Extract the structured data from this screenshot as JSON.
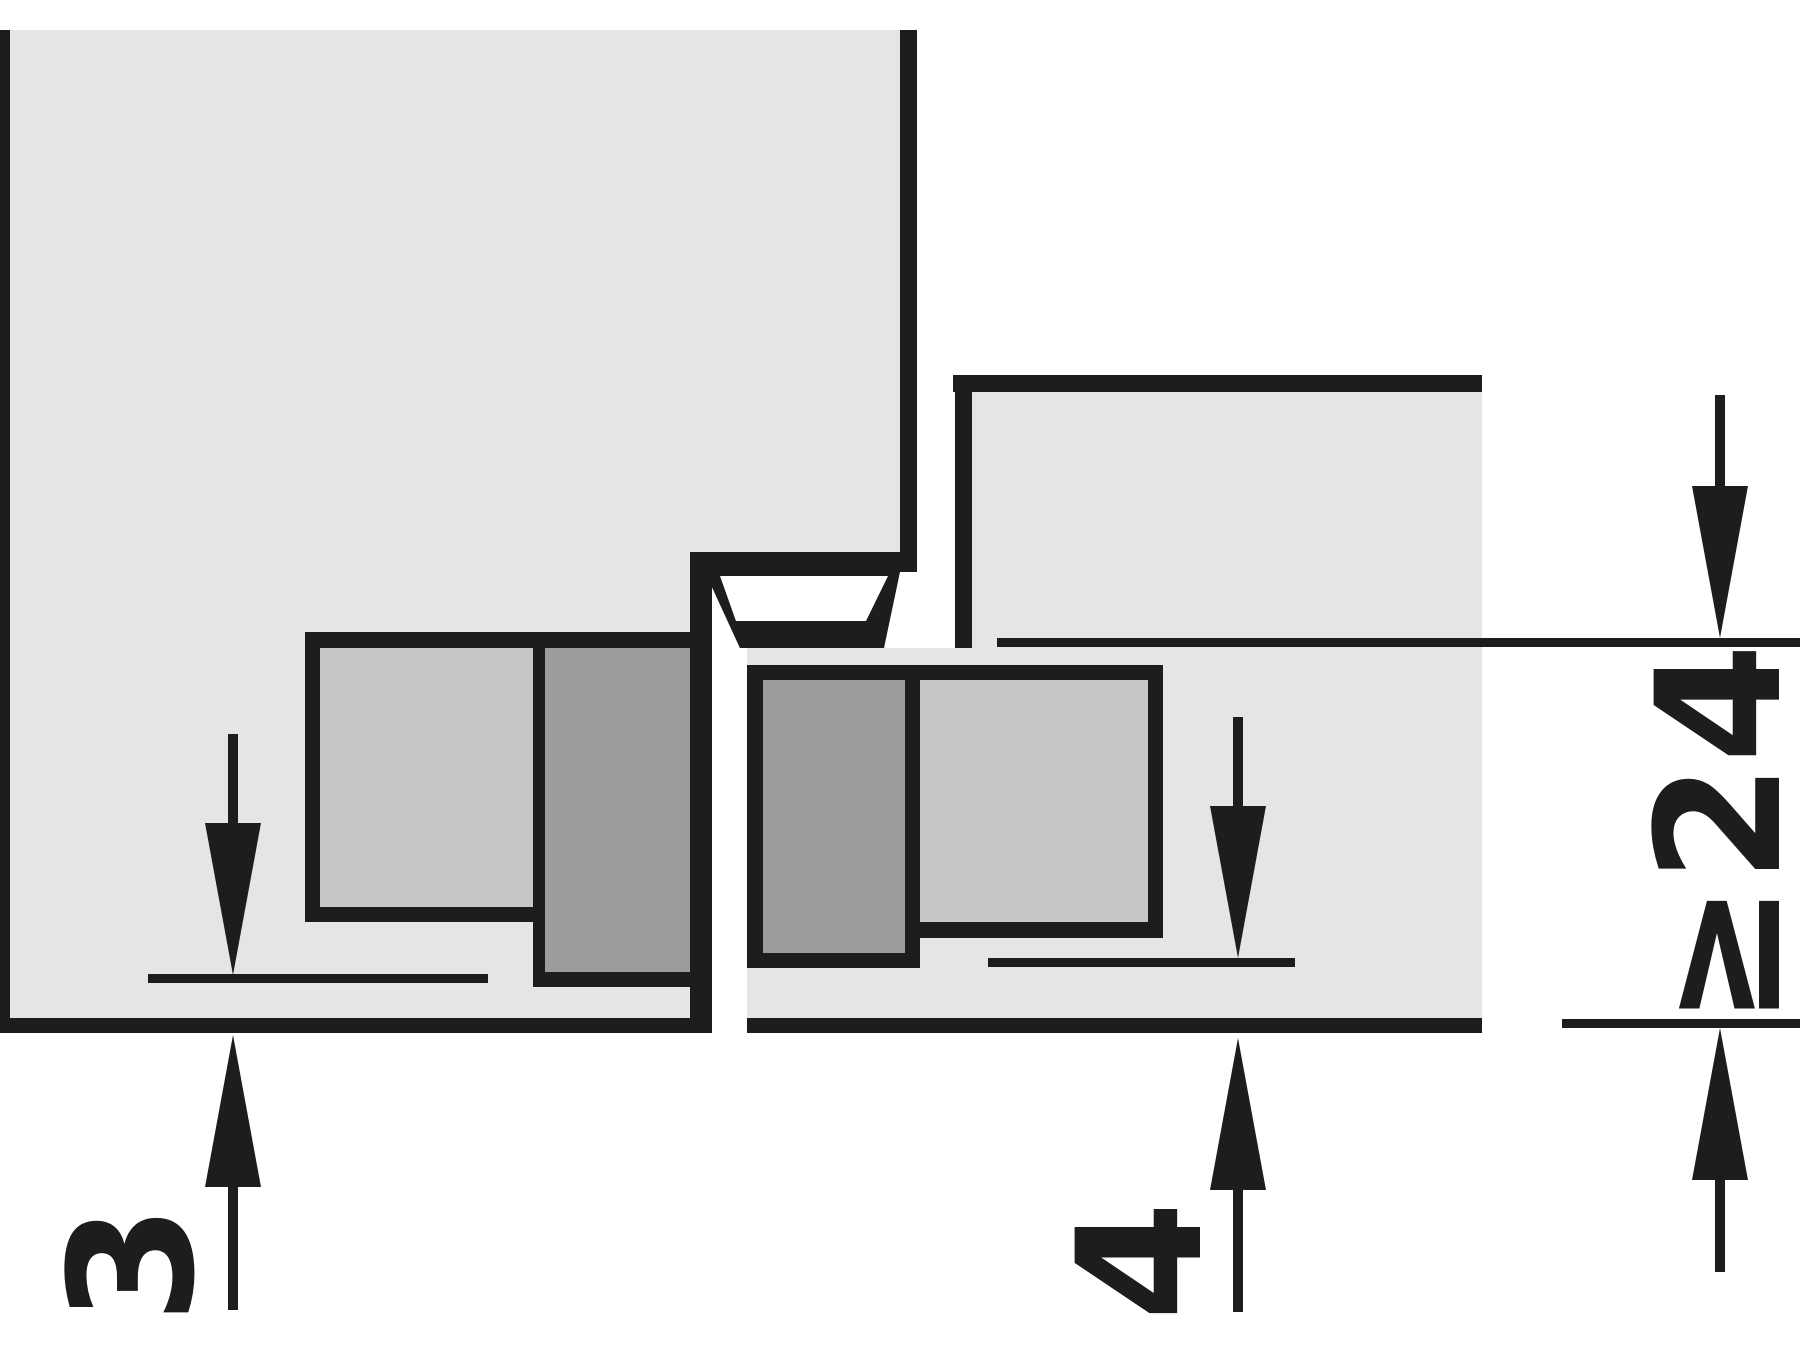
{
  "drawing": {
    "type": "technical-section-drawing",
    "subject": "concealed hinge mortised in door and frame, closed position",
    "labels": {
      "door_face_offset": "3",
      "frame_face_offset": "4",
      "min_frame_overlay": "≥24"
    },
    "colors": {
      "background": "#ffffff",
      "panel": "#e4e5e7",
      "hinge_light": "#c6c7c9",
      "hinge_dark": "#9b9c9e",
      "line": "#1d1d1f"
    }
  }
}
